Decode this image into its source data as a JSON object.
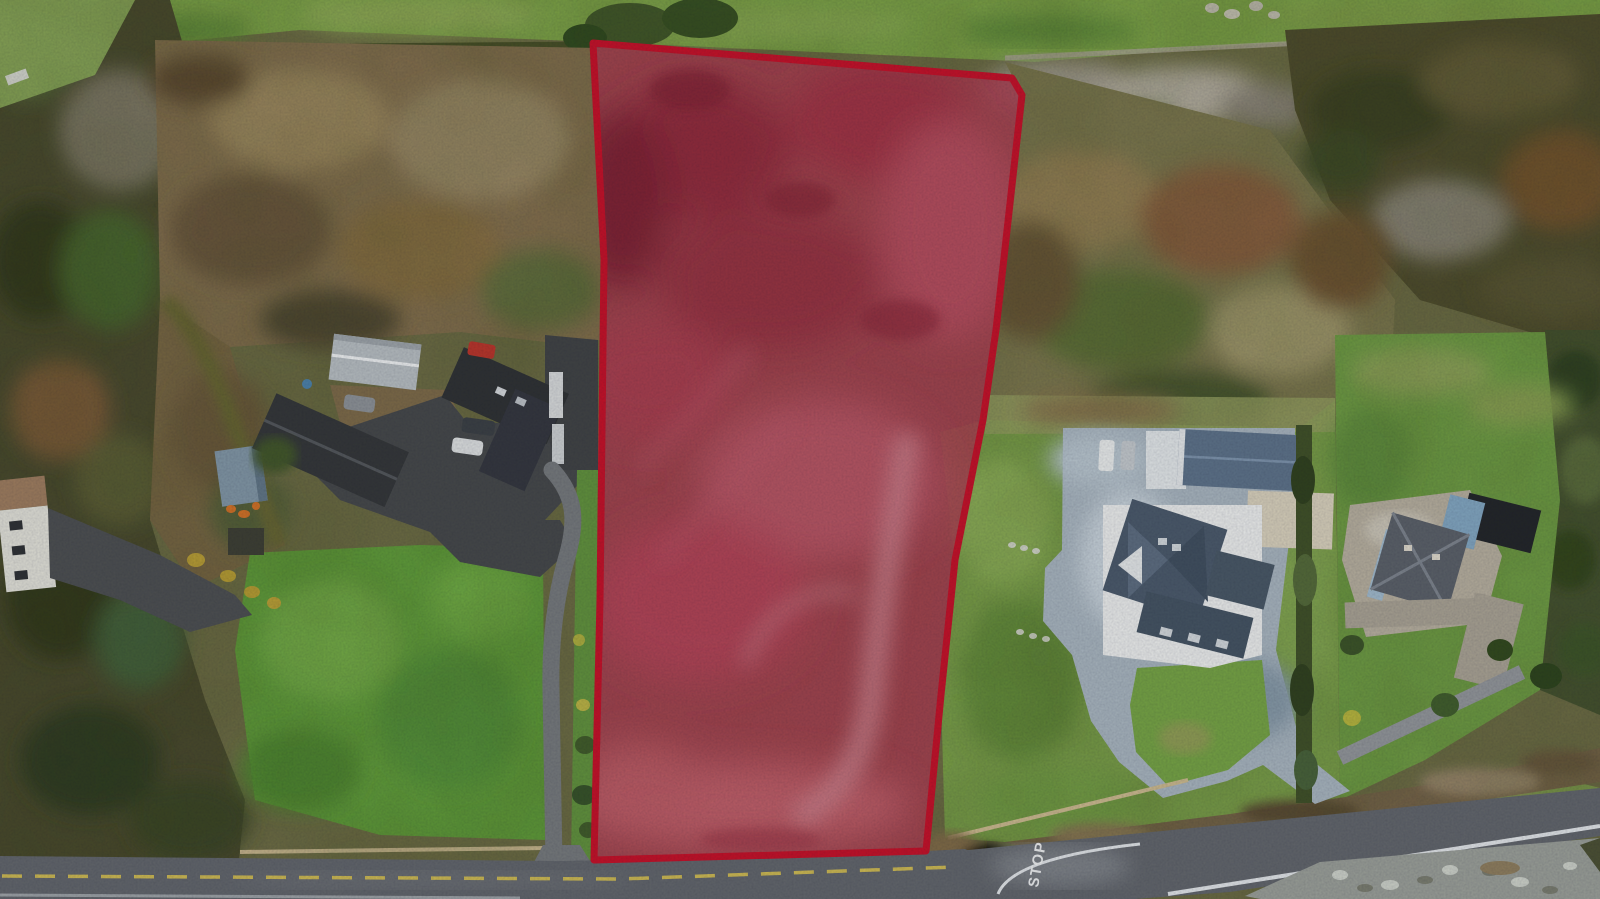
{
  "meta": {
    "type": "aerial-drone-photograph",
    "description": "Winter aerial view of a rural roadside land parcel outlined in red, flanked by a farmstead to the west and detached houses to the east, with a public road along the bottom edge.",
    "width_px": 1600,
    "height_px": 899
  },
  "parcel_overlay": {
    "name": "highlighted-site-boundary",
    "points": "593,43 1012,78 1022,95 996,330 983,420 955,560 941,695 926,851 594,860 597,730 600,600 604,260",
    "fill": "#a63c50",
    "fill_opacity": "0.85",
    "stroke": "#c1112a",
    "stroke_width": "7"
  },
  "road": {
    "stop_marking_text": "STOP",
    "surface_color": "#60646c",
    "lane_color": "#73777c",
    "edge_line_color": "#c9b654",
    "white_line_color": "#dde1e6"
  },
  "palette": {
    "field_green": "#7ba14b",
    "lawn_green": "#61a03c",
    "top_field_green": "#7fa74a",
    "far_right_lawn": "#71a147",
    "scrub_brown": "#857050",
    "right_scrub": "#7d7850",
    "woodland_dark": "#49492e",
    "right_woodland": "#4f4c2e",
    "bare_trees_grey": "#a49d92",
    "concrete_drive": "#a4b1bd",
    "asphalt_dark": "#44474b",
    "metal_barn_roof": "#b3bac0",
    "steel_garage_roof": "#5b7089",
    "house_roof_dark": "#33363a",
    "blue_house_wall": "#7fa3bf",
    "gravel": "#979c98"
  },
  "features": [
    {
      "name": "highlighted-parcel",
      "label": "red-outlined development site"
    },
    {
      "name": "main-road",
      "label": "public road along bottom edge"
    },
    {
      "name": "stop-marking",
      "label": "STOP marking at road junction"
    },
    {
      "name": "farm-lane",
      "label": "narrow lane along west side of site"
    },
    {
      "name": "left-farmstead",
      "label": "farmhouse, barn and yard west of site"
    },
    {
      "name": "far-left-cottage",
      "label": "cottage beside road at far left"
    },
    {
      "name": "right-house",
      "label": "large detached house east of site"
    },
    {
      "name": "steel-garage",
      "label": "blue-grey steel garage"
    },
    {
      "name": "right-driveway",
      "label": "concrete loop driveway to road"
    },
    {
      "name": "boundary-hedge",
      "label": "hedge between east properties"
    },
    {
      "name": "far-right-house",
      "label": "blue two-storey house at far right"
    },
    {
      "name": "gravel-verge",
      "label": "stony verge at bottom right"
    },
    {
      "name": "woodland",
      "label": "mixed woodland and winter scrub"
    },
    {
      "name": "green-fields",
      "label": "grass fields and lawns"
    }
  ]
}
